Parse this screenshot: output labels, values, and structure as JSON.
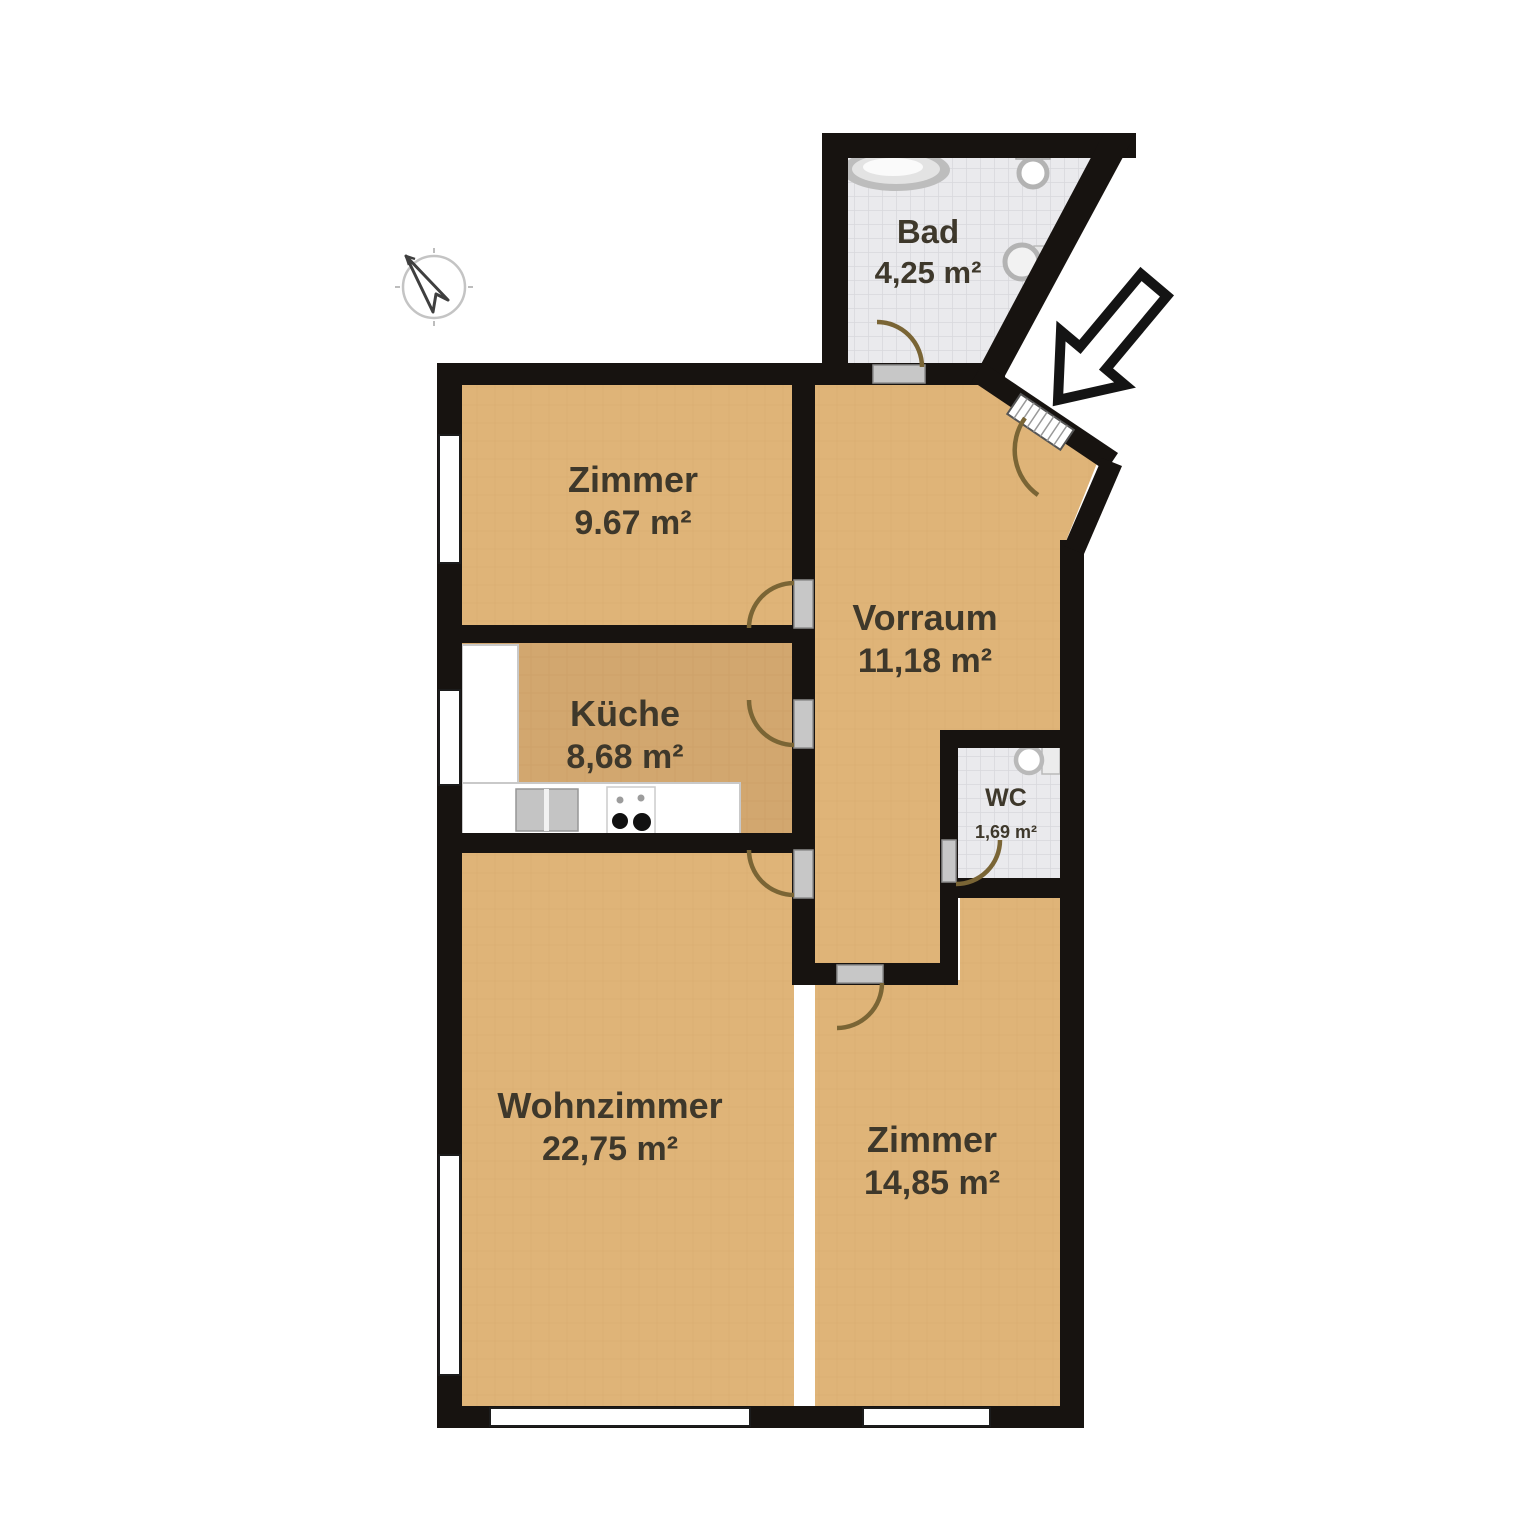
{
  "plan": {
    "type": "apartment-floor-plan",
    "language": "de",
    "rooms": [
      {
        "id": "bad",
        "name": "Bad",
        "area": "4,25 m²"
      },
      {
        "id": "zimmer1",
        "name": "Zimmer",
        "area": "9.67 m²"
      },
      {
        "id": "vorraum",
        "name": "Vorraum",
        "area": "11,18 m²"
      },
      {
        "id": "kueche",
        "name": "Küche",
        "area": "8,68 m²"
      },
      {
        "id": "wc",
        "name": "WC",
        "area": "1,69 m²"
      },
      {
        "id": "wohnzimmer",
        "name": "Wohnzimmer",
        "area": "22,75 m²"
      },
      {
        "id": "zimmer2",
        "name": "Zimmer",
        "area": "14,85 m²"
      }
    ],
    "icons": [
      "compass-icon",
      "entrance-arrow-icon",
      "bathtub-icon",
      "toilet-icon",
      "sink-icon",
      "kitchen-counter",
      "kitchen-sink-icon",
      "stove-icon"
    ],
    "colors": {
      "wall": "#171310",
      "floor_tan": "#dfb478",
      "floor_tan_line": "#d2a66a",
      "floor_kitchen": "#d2a76f",
      "tile": "#eaeaed",
      "tile_line": "#d8d8dc",
      "door_arc": "#7a6535",
      "label": "#3e382b",
      "window": "#ffffff",
      "threshold": "#c7c7c7"
    }
  }
}
